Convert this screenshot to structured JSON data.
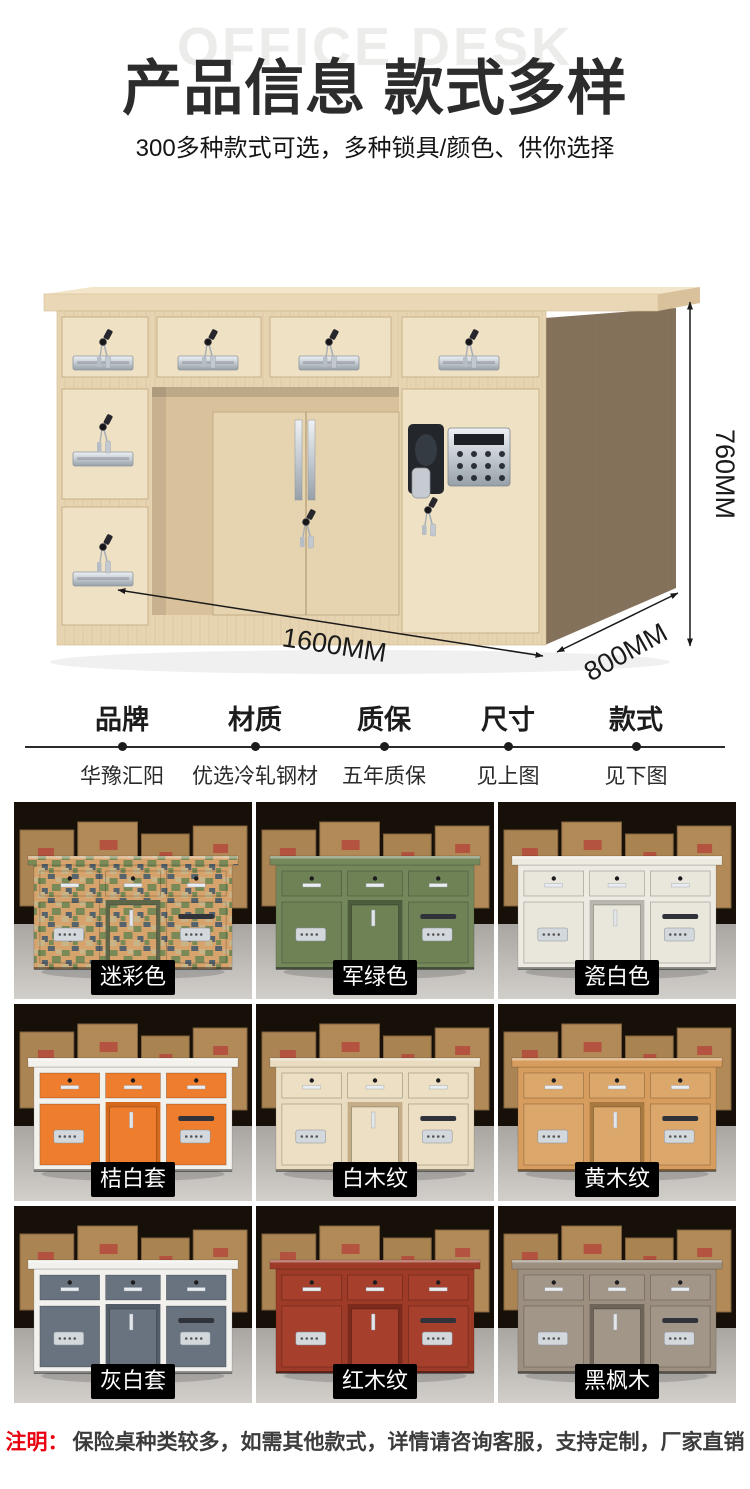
{
  "header": {
    "watermark": "OFFICE DESK",
    "title": "产品信息 款式多样",
    "subtitle": "300多种款式可选，多种锁具/颜色、供你选择"
  },
  "hero": {
    "description": "office-desk-photo",
    "dimensions": {
      "height": "760MM",
      "width": "1600MM",
      "depth": "800MM"
    },
    "colors": {
      "top": "#f2e5c9",
      "slab": "#ead7b5",
      "front": "#e7d4b1",
      "drawer": "#eee1c4",
      "inner_door": "#e6d3b0",
      "side": "#84715c"
    }
  },
  "specs": {
    "columns": [
      {
        "label": "品牌",
        "value": "华豫汇阳"
      },
      {
        "label": "材质",
        "value": "优选冷轧钢材"
      },
      {
        "label": "质保",
        "value": "五年质保"
      },
      {
        "label": "尺寸",
        "value": "见上图"
      },
      {
        "label": "款式",
        "value": "见下图"
      }
    ]
  },
  "grid": {
    "items": [
      {
        "label": "迷彩色",
        "camo": true,
        "frame": "#d6a36c",
        "panel": "#d6a36c",
        "panel2": "#5d6649"
      },
      {
        "label": "军绿色",
        "frame": "#74885c",
        "panel": "#6e8255",
        "panel2": "#4e5c3e"
      },
      {
        "label": "瓷白色",
        "frame": "#edebe1",
        "panel": "#e9e7dc",
        "panel2": "#b8b6ac"
      },
      {
        "label": "桔白套",
        "frame": "#f3f1ec",
        "panel": "#ee7e2d",
        "panel2": "#d4681c"
      },
      {
        "label": "白木纹",
        "frame": "#e9dcc0",
        "panel": "#ecdfc3",
        "panel2": "#c5ae87"
      },
      {
        "label": "黄木纹",
        "frame": "#d79d5e",
        "panel": "#dca76a",
        "panel2": "#a87a40"
      },
      {
        "label": "灰白套",
        "frame": "#f2f1ee",
        "panel": "#68737f",
        "panel2": "#525c68"
      },
      {
        "label": "红木纹",
        "frame": "#9e3a28",
        "panel": "#a63f2b",
        "panel2": "#7c2a1c"
      },
      {
        "label": "黑枫木",
        "frame": "#9c8f80",
        "panel": "#a29689",
        "panel2": "#6e6458"
      }
    ]
  },
  "note": {
    "prefix": "注明：",
    "text": "保险桌种类较多，如需其他款式，详情请咨询客服，支持定制，厂家直销"
  },
  "colors": {
    "accent_red": "#e8000f",
    "label_bg": "#000000",
    "label_text": "#ffffff"
  }
}
